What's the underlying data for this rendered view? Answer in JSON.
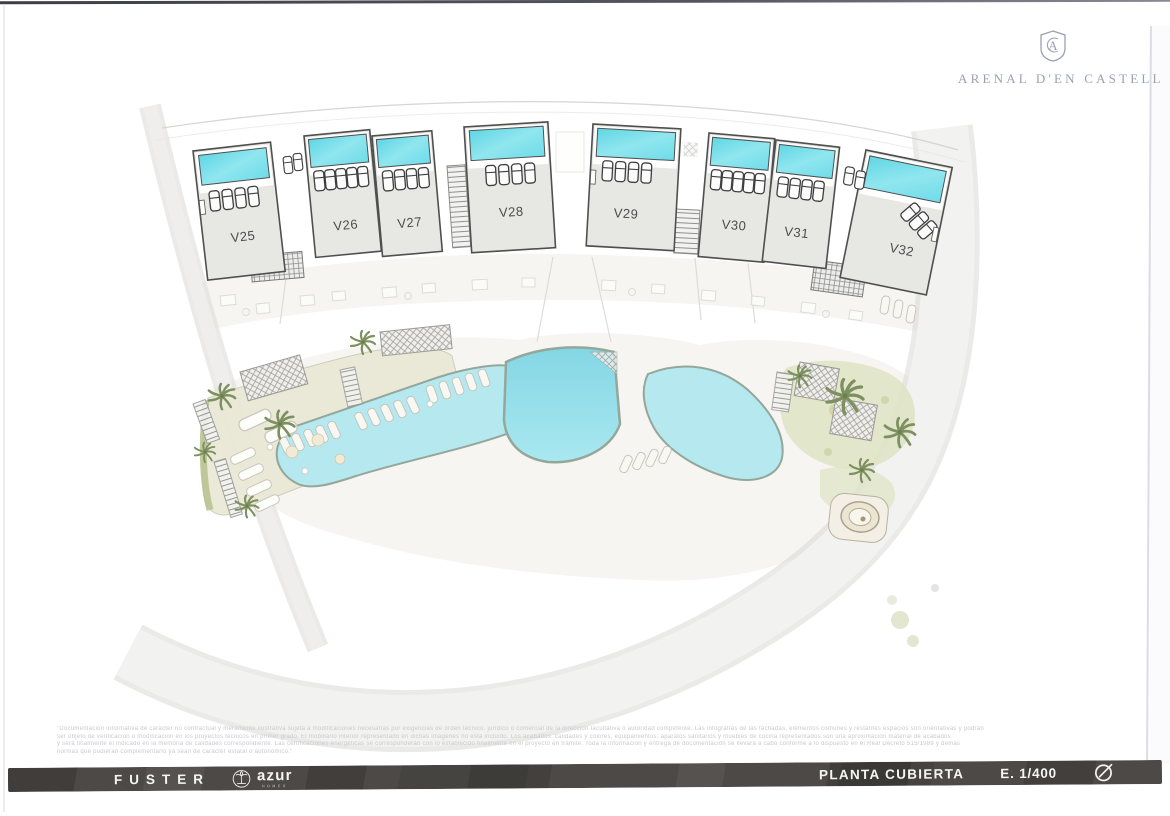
{
  "header": {
    "brand_name": "ARENAL D'EN CASTELL",
    "brand_crest_icon": "shield-monogram-crest-icon"
  },
  "plan": {
    "villas": [
      {
        "label": "V25"
      },
      {
        "label": "V26"
      },
      {
        "label": "V27"
      },
      {
        "label": "V28"
      },
      {
        "label": "V29"
      },
      {
        "label": "V30"
      },
      {
        "label": "V31"
      },
      {
        "label": "V32"
      }
    ]
  },
  "disclaimer": {
    "lines": [
      "\"Documentación informativa de carácter no contractual y meramente ilustrativa sujeta a modificaciones necesarias por exigencias de orden técnico, jurídico o comercial de la dirección facultativa o autoridad competente. Las infografías de las fachadas, elementos comunes y restantes espacios son orientativas y podrán",
      "ser objeto de verificación o modificación en los proyectos técnicos en primer grado. El mobiliario interior representado en dichas imágenes no está incluido. Los acabados, calidades y colores, equipamientos, aparatos sanitarios y muebles de cocina representados son una aproximación material de acabados",
      "y será finalmente el indicado en la memoria de calidades correspondiente. Las certificaciones energéticas se corresponderán con lo establecido finalmente en el proyecto en trámite. Toda la información y entrega de documentación se llevará a cabo conforme a lo dispuesto en el Real Decreto 515/1989 y demás",
      "normas que pudieran complementarlo ya sean de carácter estatal o autonómico.\""
    ]
  },
  "footer": {
    "developer_brand": "FUSTER",
    "agency_brand": "azur",
    "agency_brand_sub": "HOMES",
    "agency_emblem_icon": "palm-emblem-icon",
    "sheet_title": "PLANTA CUBIERTA",
    "scale": "E. 1/400",
    "north_icon": "compass-north-icon"
  },
  "colors": {
    "pool_cyan": "#6FDCE9",
    "pool_deep": "#8FD9E6",
    "footer_bar": "#4B4845",
    "brand_blue_gray": "#9AA0B2",
    "deck_beige": "#EAE8D6",
    "garden_green": "#DFE4C6"
  }
}
